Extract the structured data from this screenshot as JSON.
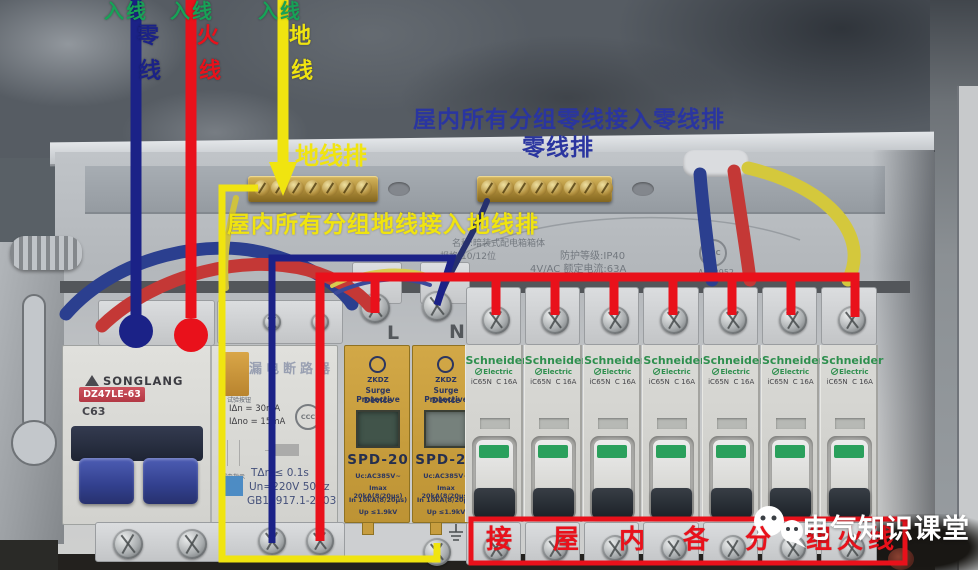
{
  "annotations": {
    "incoming_labels": [
      {
        "tag": "入线",
        "char1": "零",
        "char2": "线"
      },
      {
        "tag": "入线",
        "char1": "火",
        "char2": "线"
      },
      {
        "tag": "入线",
        "char1": "地",
        "char2": "线"
      }
    ],
    "ground_bar_label": "地线排",
    "neutral_note_line1": "屋内所有分组零线接入零线排",
    "neutral_note_line2": "零线排",
    "ground_note": "屋内所有分组地线接入地线排",
    "branch_live_chars": [
      "接",
      "屋",
      "内",
      "各",
      "分",
      "组",
      "火",
      "线"
    ],
    "watermark": "电气知识课堂"
  },
  "panel": {
    "info_line1": "名称:暗装式配电箱箱体",
    "info_line2": "规格:10/12位",
    "info_line3": "防护等级:IP40",
    "info_line4": "4V/AC 额定电流:63A",
    "ccc_label": "CCC",
    "ccc_serial": "A062952"
  },
  "main_breaker": {
    "brand": "SONGLANG",
    "model": "DZ47LE-63",
    "rating": "C63",
    "module_title": "漏电断路器",
    "test_label": "试验按钮",
    "spec1": "IΔn  =  30mA",
    "spec2": "IΔno =  15mA",
    "indicator_label": "漏电指示",
    "spec3": "TΔn ≤ 0.1s",
    "spec4": "Un=220V 50Hz",
    "spec5": "GB16917.1-2003"
  },
  "spd": {
    "terminal_l": "L",
    "terminal_n": "N",
    "brand": "ZKDZ",
    "desc_line1": "Surge Protective",
    "desc_line2": "Device",
    "model": "SPD-20",
    "spec1": "Uc:AC385V~",
    "spec2": "Imax 20kA(8/20μs)",
    "spec3": "In 10kA(8/20μs)",
    "spec4": "Up ≤1.9kV",
    "count": 2
  },
  "branch_breakers": {
    "brand": "Schneider",
    "brand_sub": "Electric",
    "model": "iC65N  C 16A",
    "count": 7
  },
  "colors": {
    "annotation_green": "#17a257",
    "annotation_navy": "#1b2287",
    "annotation_red": "#e9111b",
    "annotation_yellow": "#f0e410",
    "note_blue": "#2a35a0",
    "schneider_green": "#2e8f4e",
    "spd_yellow": "#c79d3f"
  }
}
